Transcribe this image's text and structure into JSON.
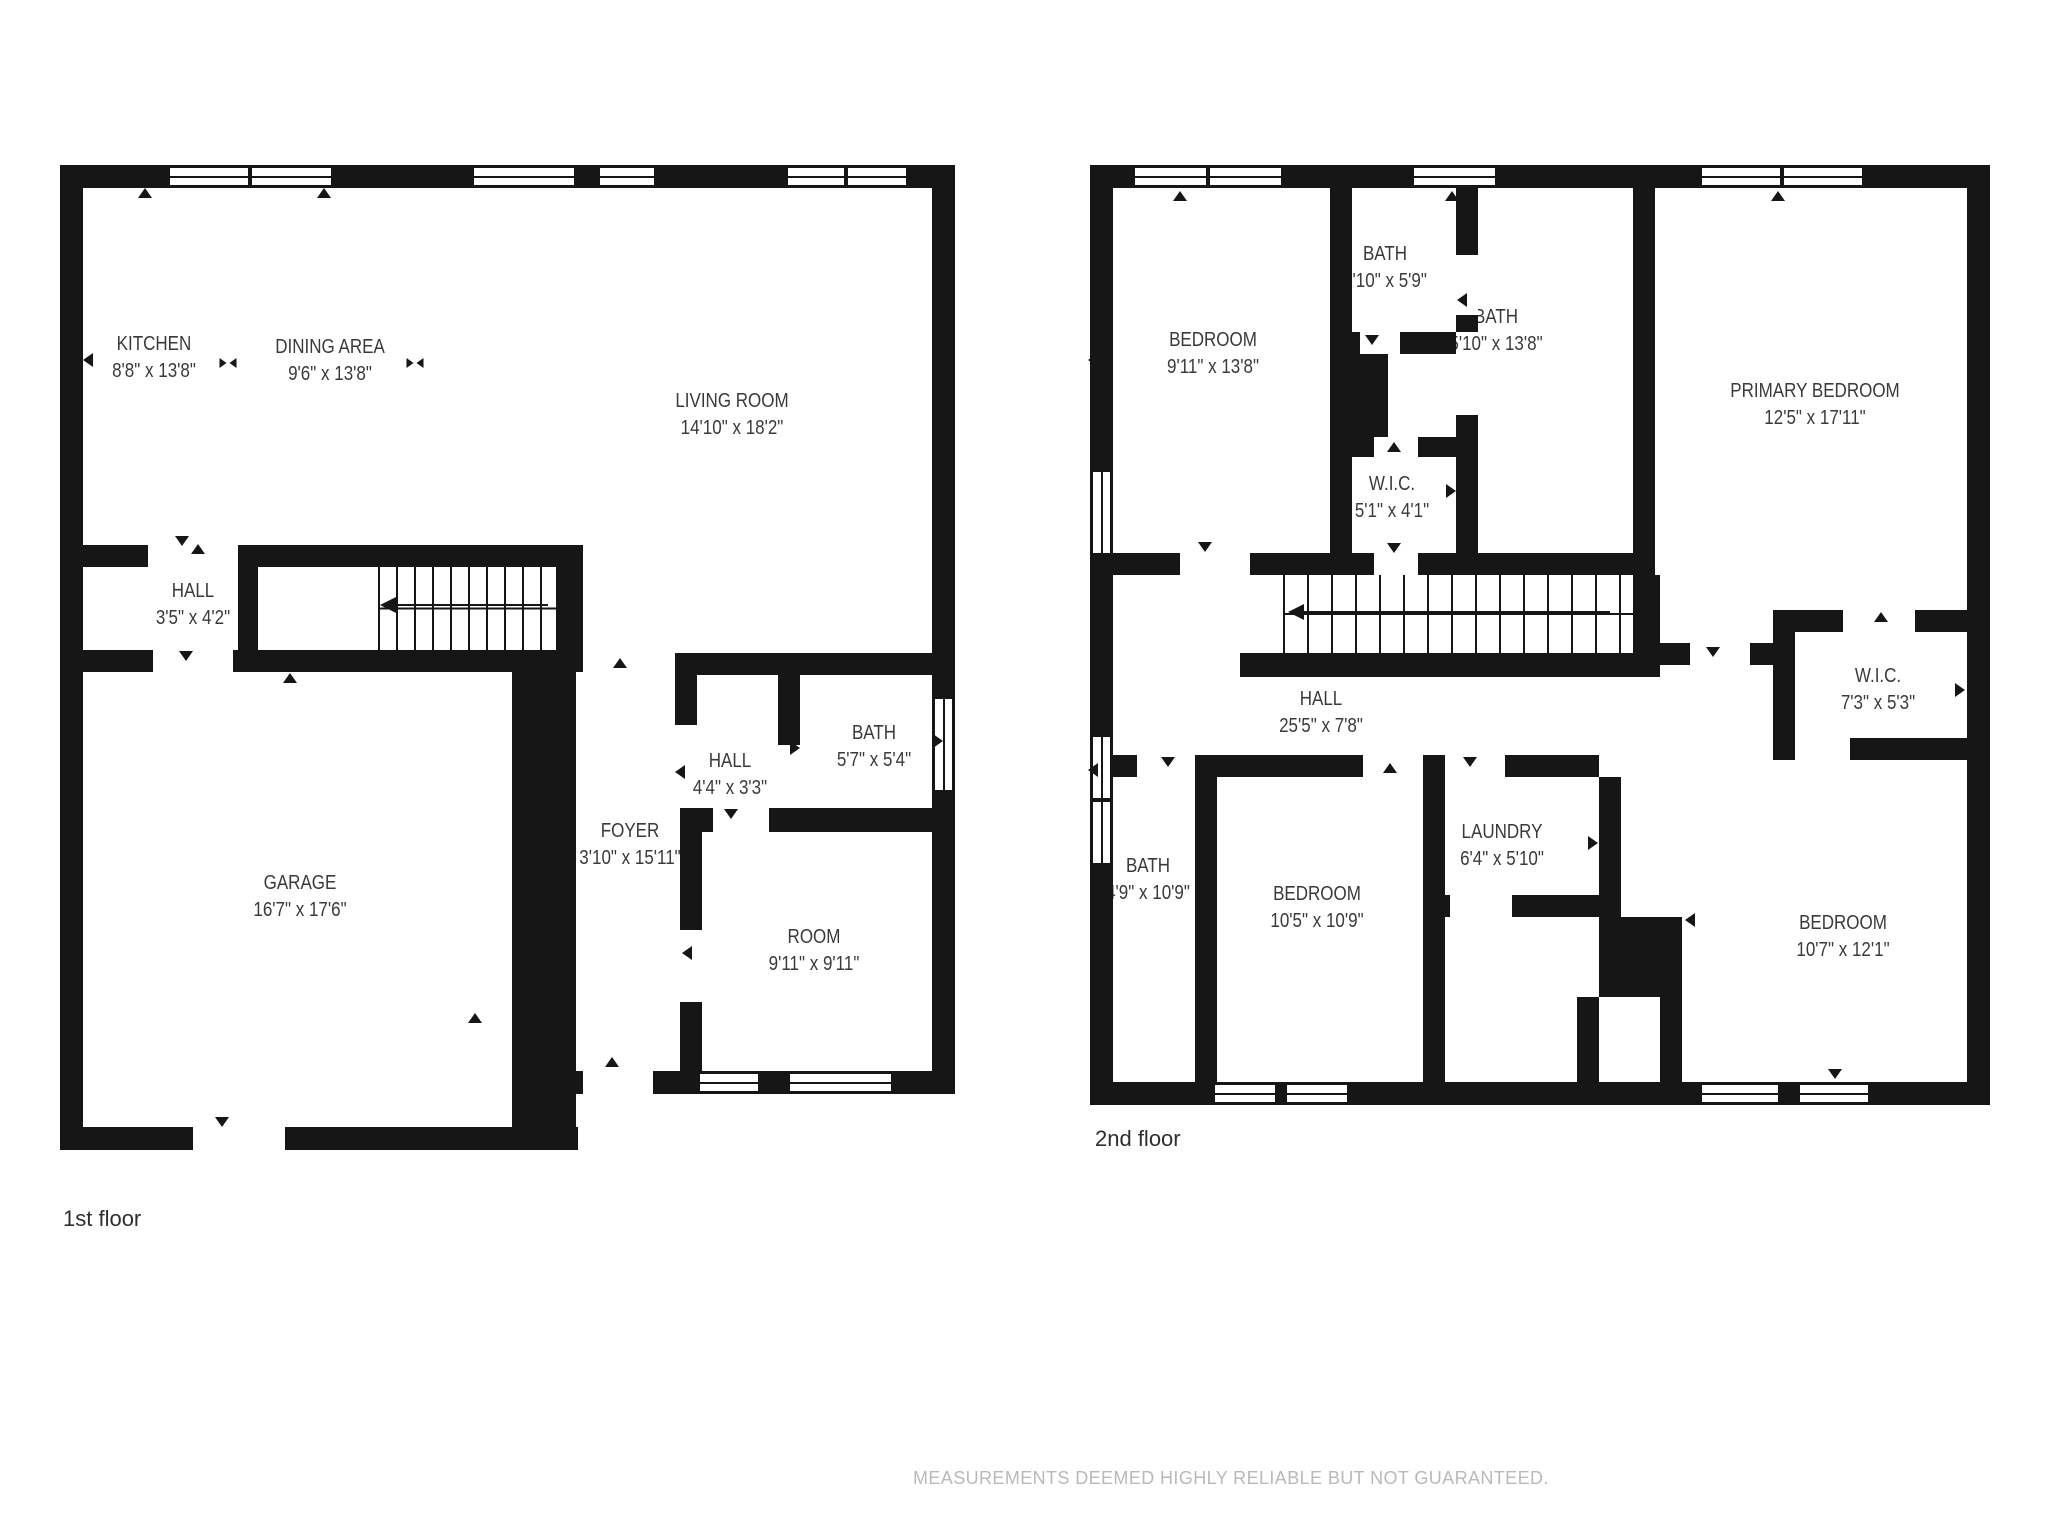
{
  "floors": [
    {
      "caption": "1st floor",
      "rooms": [
        {
          "name": "KITCHEN",
          "dims": "8'8\" x 13'8\""
        },
        {
          "name": "DINING AREA",
          "dims": "9'6\" x 13'8\""
        },
        {
          "name": "LIVING ROOM",
          "dims": "14'10\" x 18'2\""
        },
        {
          "name": "HALL",
          "dims": "3'5\" x 4'2\""
        },
        {
          "name": "GARAGE",
          "dims": "16'7\" x 17'6\""
        },
        {
          "name": "FOYER",
          "dims": "3'10\" x 15'11\""
        },
        {
          "name": "HALL",
          "dims": "4'4\" x 3'3\""
        },
        {
          "name": "BATH",
          "dims": "5'7\" x 5'4\""
        },
        {
          "name": "ROOM",
          "dims": "9'11\" x 9'11\""
        }
      ]
    },
    {
      "caption": "2nd floor",
      "rooms": [
        {
          "name": "BEDROOM",
          "dims": "9'11\" x 13'8\""
        },
        {
          "name": "BATH",
          "dims": "3'10\" x 5'9\""
        },
        {
          "name": "BATH",
          "dims": "5'10\" x 13'8\""
        },
        {
          "name": "PRIMARY BEDROOM",
          "dims": "12'5\" x 17'11\""
        },
        {
          "name": "W.I.C.",
          "dims": "5'1\" x 4'1\""
        },
        {
          "name": "HALL",
          "dims": "25'5\" x 7'8\""
        },
        {
          "name": "W.I.C.",
          "dims": "7'3\" x 5'3\""
        },
        {
          "name": "BATH",
          "dims": "4'9\" x 10'9\""
        },
        {
          "name": "BEDROOM",
          "dims": "10'5\" x 10'9\""
        },
        {
          "name": "LAUNDRY",
          "dims": "6'4\" x 5'10\""
        },
        {
          "name": "BEDROOM",
          "dims": "10'7\" x 12'1\""
        }
      ]
    }
  ],
  "footer": {
    "disclaimer": "MEASUREMENTS DEEMED HIGHLY RELIABLE BUT NOT GUARANTEED."
  },
  "colors": {
    "wall": "#161616",
    "label_text": "#3a3a3a",
    "disclaimer_text": "#b9b9b9"
  }
}
